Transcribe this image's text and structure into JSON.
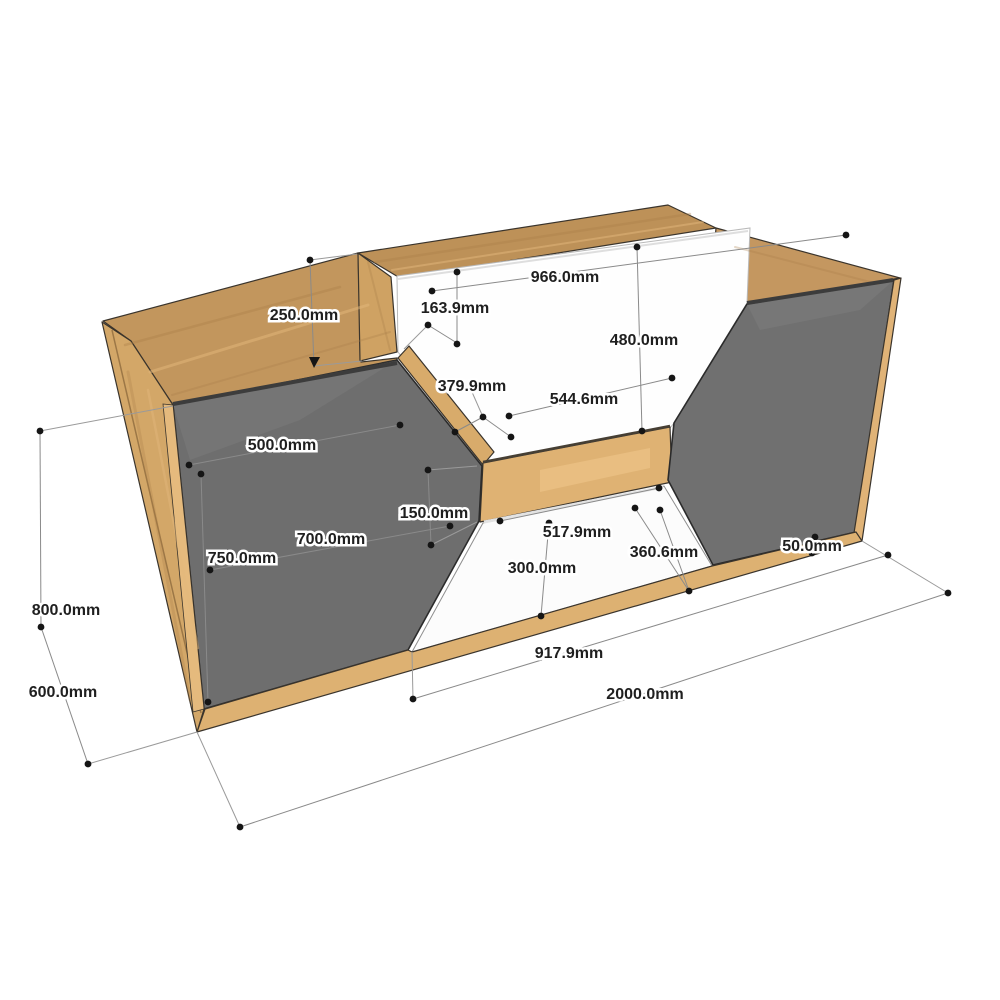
{
  "drawing": {
    "title": "dimensioned-cabinet-3d-drawing",
    "unit": "mm",
    "style": "sketchup-perspective",
    "materials": {
      "body": "light oak wood",
      "front_panels": "dark gray",
      "counter_face": "white"
    },
    "colors": {
      "background": "#ffffff",
      "wood_top": "#c2965d",
      "wood_side": "#d3a768",
      "wood_light": "#e5ba7d",
      "wood_band": "#dfb273",
      "panel_gray": "#6e6e6e",
      "white_face": "#fefefe",
      "outline": "#2b2b2b",
      "dim_line": "#8a8a8a",
      "dim_text": "#1f1f1f"
    },
    "dimensions": [
      {
        "id": "counter-front-width",
        "label": "966.0mm"
      },
      {
        "id": "counter-left-inset",
        "label": "163.9mm"
      },
      {
        "id": "counter-front-height",
        "label": "480.0mm"
      },
      {
        "id": "niche-left-slant",
        "label": "379.9mm"
      },
      {
        "id": "niche-shelf-width",
        "label": "544.6mm"
      },
      {
        "id": "counter-raise-height",
        "label": "250.0mm"
      },
      {
        "id": "left-top-width",
        "label": "500.0mm"
      },
      {
        "id": "left-door-width",
        "label": "700.0mm"
      },
      {
        "id": "left-door-height",
        "label": "750.0mm"
      },
      {
        "id": "shelf-band-height",
        "label": "150.0mm"
      },
      {
        "id": "recess-top-width",
        "label": "517.9mm"
      },
      {
        "id": "recess-height",
        "label": "300.0mm"
      },
      {
        "id": "recess-right-slant",
        "label": "360.6mm"
      },
      {
        "id": "base-height",
        "label": "50.0mm"
      },
      {
        "id": "overall-height",
        "label": "800.0mm"
      },
      {
        "id": "overall-depth",
        "label": "600.0mm"
      },
      {
        "id": "recess-bottom-width",
        "label": "917.9mm"
      },
      {
        "id": "overall-width",
        "label": "2000.0mm"
      }
    ]
  }
}
